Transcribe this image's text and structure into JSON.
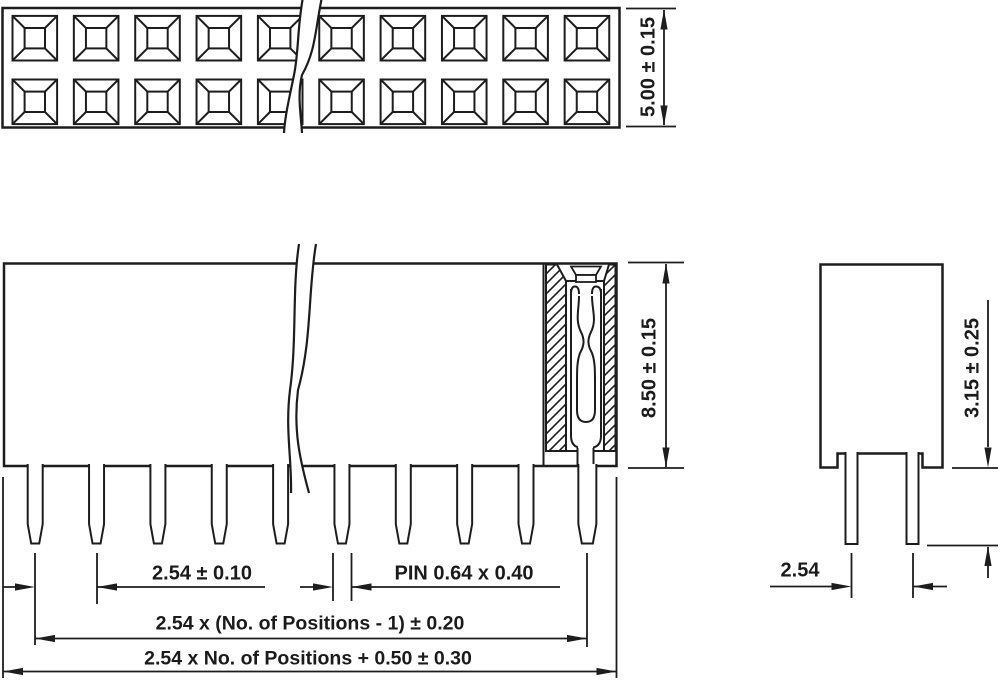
{
  "drawing": {
    "type": "connector-dimension-drawing",
    "component": "dual-row female header socket"
  },
  "colors": {
    "line": "#1d1d1d",
    "background": "#ffffff",
    "text": "#1b1b1b"
  },
  "views": {
    "top": {
      "socket_rows": 2,
      "socket_columns": 10
    },
    "front": {
      "pin_count": 10
    },
    "side": {
      "pin_count": 2
    }
  },
  "dimensions": {
    "top_width": "5.00 ± 0.15",
    "body_height": "8.50 ± 0.15",
    "pin_protrusion": "3.15 ± 0.25",
    "row_spacing": "2.54",
    "pin_pitch": "2.54 ± 0.10",
    "pin_cross_section": "PIN 0.64 x 0.40",
    "span_between_end_pins": "2.54 x (No. of Positions - 1) ± 0.20",
    "overall_length": "2.54 x No. of Positions + 0.50 ± 0.30"
  }
}
